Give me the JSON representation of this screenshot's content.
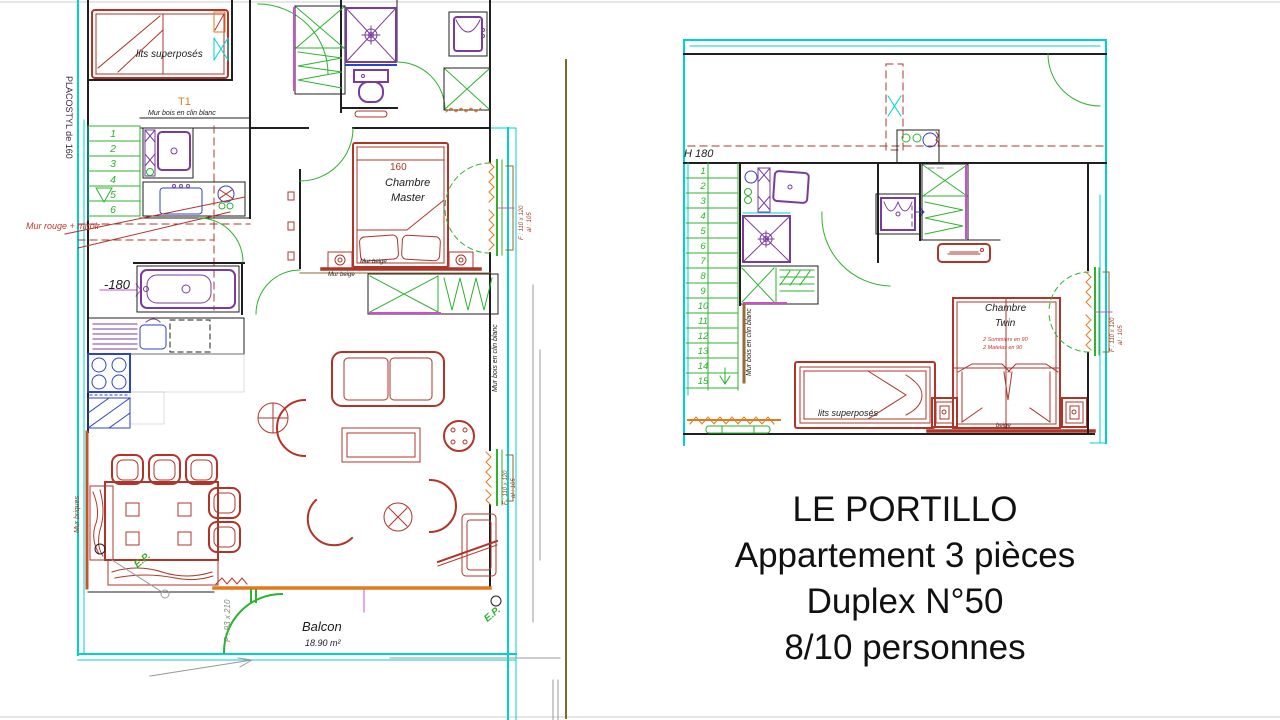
{
  "palette": {
    "wall_cyan": "#00d2d2",
    "cad_green": "#2db32d",
    "furniture_red": "#b03528",
    "fixture_purple": "#7a3ba0",
    "radiator_orange": "#e07a1f",
    "detail_blue": "#2d43c8",
    "wood_brown": "#9a6a35"
  },
  "title_block": {
    "line1": "LE PORTILLO",
    "line2": "Appartement 3 pièces",
    "line3": "Duplex N°50",
    "line4": "8/10 personnes"
  },
  "lower_floor": {
    "stairs": [
      "1",
      "2",
      "3",
      "4",
      "5",
      "6"
    ],
    "labels": {
      "placostyl": "PLACOSTYL de 160",
      "bunk_bed": "lits superposés",
      "unit": "T1",
      "wall_wood_top": "Mur bois en clin blanc",
      "wall_red_mirror": "Mur rouge + miroir",
      "level": "-180",
      "master_width": "160",
      "master_room_1": "Chambre",
      "master_room_2": "Master",
      "wall_beige_a": "Mur beige",
      "wall_beige_b": "Mur beige",
      "wall_wood_right": "Mur bois en clin blanc",
      "wall_bricks": "Mur briques",
      "window_size": "F : 110 x 120",
      "window_sill": "al : 105",
      "window_size_2": "F : 110 x 120",
      "window_sill_2": "al : 105",
      "door_size": "P : 93 x 210",
      "rain_pipe_a": "E.P.",
      "rain_pipe_b": "E.P.",
      "balcony": "Balcon",
      "balcony_area": "18.90 m²"
    }
  },
  "upper_floor": {
    "stairs": [
      "1",
      "2",
      "3",
      "4",
      "5",
      "6",
      "7",
      "8",
      "9",
      "10",
      "11",
      "12",
      "13",
      "14",
      "15"
    ],
    "labels": {
      "height": "H 180",
      "wall_wood": "Mur bois en clin blanc",
      "twin_room_1": "Chambre",
      "twin_room_2": "Twin",
      "twin_note_1": "2 Sommiers en 90",
      "twin_note_2": "2 Matelas en 90",
      "wall_beige": "beige",
      "bunk_bed": "lits superposés",
      "window_size": "F : 110 x 120",
      "window_sill": "al : 105"
    }
  }
}
